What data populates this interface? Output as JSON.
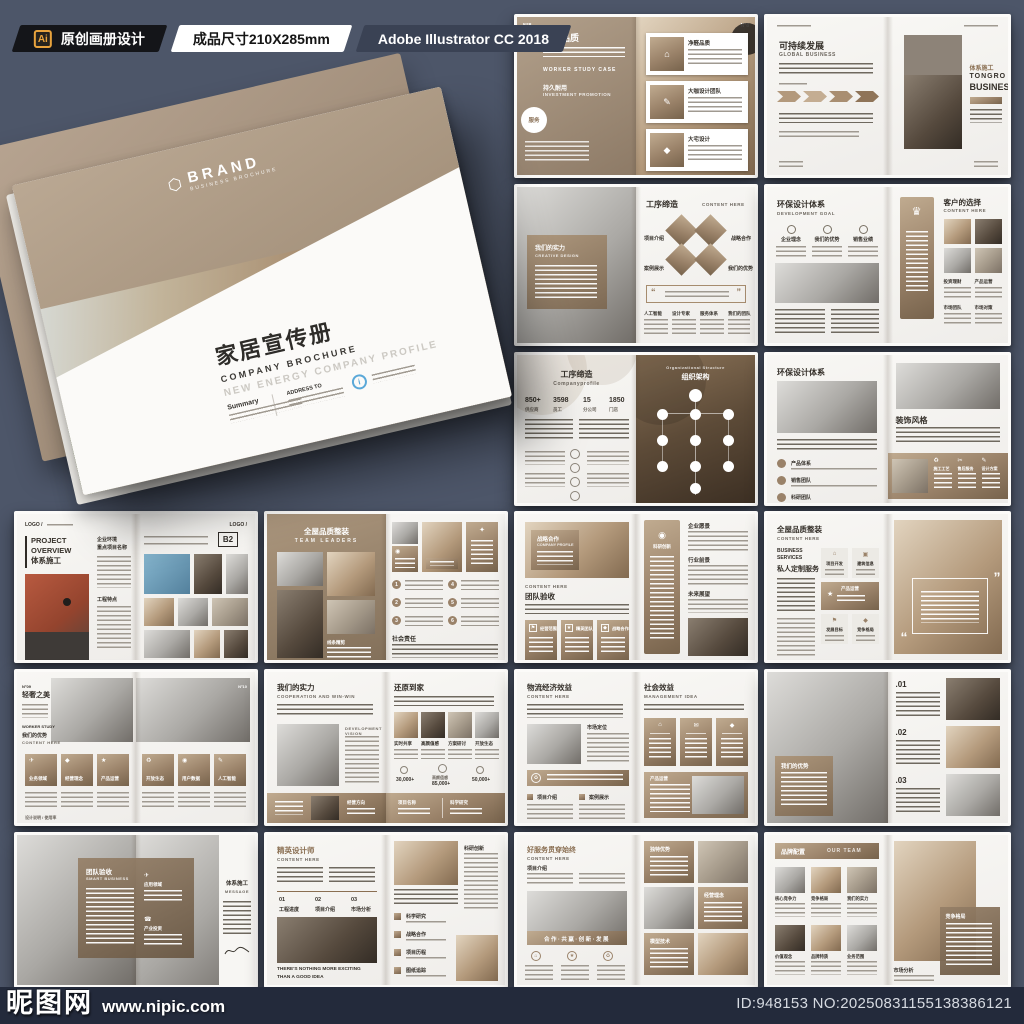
{
  "header": {
    "ai_badge": "Ai",
    "tag1": "原创画册设计",
    "tag2": "成品尺寸210X285mm",
    "tag3": "Adobe Illustrator CC 2018"
  },
  "cover": {
    "brand": "BRAND",
    "brand_sub": "BUSINESS BROCHURE",
    "title": "家居宣传册",
    "subtitle": "COMPANY BROCHURE",
    "tagline": "NEW ENERGY COMPANY PROFILE",
    "summary_label": "Summary",
    "address_label": "ADDRESS TO",
    "info_mark": "i"
  },
  "footer": {
    "watermark_name": "昵图网",
    "watermark_url": "www.nipic.com",
    "id_text": "ID:948153 NO:20250831155138386121"
  },
  "icons": {
    "home": "⌂",
    "pen": "✎",
    "mail": "✉",
    "phone": "☎",
    "plane": "✈",
    "star": "★",
    "recycle": "♻",
    "diamond": "◆",
    "target": "◉",
    "scissors": "✂",
    "trophy": "♛",
    "spark": "✦",
    "flag": "⚑",
    "square": "▣"
  },
  "spreads": [
    {
      "no_l": "N°8",
      "no_r": "N°8",
      "title_l": "净醛品质",
      "tags": "WORKER  STUDY  CASE",
      "sub_cn": "持久耐用",
      "sub_en": "INVESTMENT PROMOTION",
      "badge": "服务",
      "cards": [
        "净醛品质",
        "大咖设计团队",
        "大宅设计"
      ]
    },
    {
      "title_l": "可持续发展",
      "sub_l": "GLOBAL BUSINESS",
      "title_r": "体系施工",
      "logo_r1": "TONGRO",
      "logo_r2": "BUSINESS"
    },
    {
      "overlay_cn": "我们的实力",
      "overlay_en": "CREATIVE DESIGN",
      "title_r": "工序缔造",
      "sub_r": "CONTENT HERE",
      "diamonds": [
        "项目介绍",
        "战略合作",
        "案例展示",
        "我们的优势"
      ],
      "cols": [
        "人工智能",
        "设计专家",
        "服务体系",
        "我们的团队"
      ],
      "quote_open": "“",
      "quote_close": "”"
    },
    {
      "title_l": "环保设计体系",
      "sub_l": "DEVELOPMENT GOAL",
      "cols_l": [
        "企业理念",
        "我们的优势",
        "销售业绩"
      ],
      "title_r": "客户的选择",
      "sub_r": "CONTENT HERE",
      "cols_r": [
        "投资理财",
        "产品运营",
        "市场团队",
        "市场对策"
      ]
    },
    {
      "title_l": "工序缔造",
      "sub_l": "Companyprofile",
      "stats": [
        {
          "v": "850+",
          "l": "供应商"
        },
        {
          "v": "3598",
          "l": "员工"
        },
        {
          "v": "15",
          "l": "分公司"
        },
        {
          "v": "1850",
          "l": "门店"
        }
      ],
      "title_r": "组织架构",
      "sub_r": "Organizational Structure"
    },
    {
      "title_l": "环保设计体系",
      "bullets": [
        "产品体系",
        "销售团队",
        "科研团队"
      ],
      "title_r": "装饰风格",
      "band": [
        "施工工艺",
        "售后服务",
        "设计方案"
      ]
    },
    {
      "logo": "LOGO /",
      "title_en1": "PROJECT",
      "title_en2": "OVERVIEW",
      "title_cn": "体系施工",
      "col1": "企业环境",
      "col2": "重点项目名称",
      "col3": "工程特点",
      "badge": "B2"
    },
    {
      "title_l": "全屋品质整装",
      "sub_l": "TEAM LEADERS",
      "label_l": "线条精剪",
      "sec_r": "社会责任",
      "nums": [
        "1",
        "2",
        "3",
        "4",
        "5",
        "6"
      ]
    },
    {
      "overlay_cn": "战略合作",
      "overlay_en": "COMPANY PROFILE",
      "sub_l": "CONTENT HERE",
      "title_l": "团队验收",
      "cards": [
        "经营范围",
        "精英团队",
        "战略合作"
      ],
      "panel_r": "科研创新",
      "cols_r": [
        "企业愿景",
        "行业前景",
        "未来展望"
      ]
    },
    {
      "title_l": "全屋品质整装",
      "sub_l": "CONTENT HERE",
      "sec_en1": "BUSINESS",
      "sec_en2": "SERVICES",
      "sec_cn": "私人定制服务",
      "cards": [
        "项目开发",
        "建筑信息",
        "产品运营",
        "发展目标",
        "竞争格局"
      ],
      "quote_open": "“",
      "quote_close": "”"
    },
    {
      "no_l": "N°09",
      "title_l": "轻奢之美",
      "no_r": "N°10",
      "tags": "WORKER  STUDY",
      "sub_cn": "我们的优势",
      "sub_en": "CONTENT HERE",
      "cards": [
        "业务领域",
        "经营理念",
        "产品运营",
        "开放生态",
        "用户数据",
        "人工智能"
      ],
      "footer": "设计说明 / 使用率"
    },
    {
      "title_l": "我们的实力",
      "sub_l": "COOPERATION AND WIN-WIN",
      "vision": "DEVELOPMENT VISION",
      "title_r": "还原到家",
      "photos": [
        "实时共享",
        "高颜值感",
        "方案研讨",
        "开放生态"
      ],
      "stats": [
        "30,000+",
        "85,000+",
        "50,000+"
      ],
      "stat_label": "高颜值感",
      "band": [
        "经营方向",
        "项目名称",
        "科学研究"
      ]
    },
    {
      "title_l": "物流经济效益",
      "sub_l": "CONTENT HERE",
      "label1": "市场定位",
      "secs": [
        "项目介绍",
        "案例展示"
      ],
      "title_r": "社会效益",
      "sub_r": "MANAGEMENT IDEA",
      "panel": "产品运营"
    },
    {
      "overlay": "我们的优势",
      "items": [
        ".01",
        ".02",
        ".03"
      ]
    },
    {
      "overlay_cn": "团队验收",
      "overlay_en": "SMART BUSINESS",
      "icons": [
        "应用领域",
        "产业投资"
      ],
      "panel_cn": "体系施工",
      "panel_en": "MESSAGE"
    },
    {
      "title_l": "精英设计师",
      "sub_l": "CONTENT HERE",
      "steps": [
        {
          "n": "01",
          "l": "工程进度"
        },
        {
          "n": "02",
          "l": "项目介绍"
        },
        {
          "n": "03",
          "l": "市场分析"
        }
      ],
      "quote1": "THERE'S NOTHING MORE EXCITING",
      "quote2": "THAN A GOOD IDEA",
      "label_r": "科研创新",
      "list": [
        "科学研究",
        "战略合作",
        "项目历程",
        "图纸追踪"
      ]
    },
    {
      "title_l": "好服务贯穿始终",
      "sub_l": "CONTENT HERE",
      "label1": "项目介绍",
      "band": "合作·共赢·创新·发展",
      "cards_r": [
        "独特优势",
        "经营理念",
        "模型技术"
      ]
    },
    {
      "title_l": "品牌配置",
      "sub_l": "OUR TEAM",
      "grid": [
        "核心竞争力",
        "竞争格局",
        "我们的实力",
        "价值观念",
        "品牌特质",
        "业务范围"
      ],
      "label_r": "市场分析",
      "card_r": "竞争格局"
    }
  ]
}
